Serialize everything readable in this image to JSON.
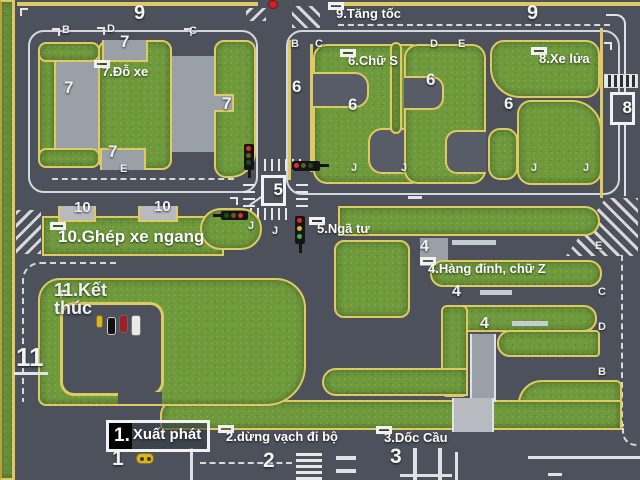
{
  "stations": {
    "start": {
      "num": "1.",
      "label": "Xuất phát"
    },
    "crosswalk": {
      "label": "2.dừng vạch đi bộ"
    },
    "bridge": {
      "label": "3.Dốc Cầu"
    },
    "zigzag": {
      "label": "4.Hàng đinh, chữ Z"
    },
    "intersection": {
      "label": "5.Ngã tư",
      "box": "5"
    },
    "s_curve": {
      "label": "6.Chữ S"
    },
    "parking": {
      "label": "7.Đỗ xe"
    },
    "railway": {
      "label": "8.Xe lửa",
      "box": "8"
    },
    "accelerate": {
      "label": "9.Tăng tốc"
    },
    "parallel": {
      "label": "10.Ghép xe ngang"
    },
    "finish": {
      "label": "11.Kết thúc",
      "big": "11"
    }
  },
  "markers": {
    "numbers": [
      {
        "text": "9",
        "x": 134,
        "y": 3,
        "size": 20
      },
      {
        "text": "9",
        "x": 527,
        "y": 3,
        "size": 20
      },
      {
        "text": "7",
        "x": 120,
        "y": 33,
        "size": 17
      },
      {
        "text": "7",
        "x": 64,
        "y": 79,
        "size": 17
      },
      {
        "text": "7",
        "x": 108,
        "y": 143,
        "size": 17
      },
      {
        "text": "7",
        "x": 222,
        "y": 95,
        "size": 17
      },
      {
        "text": "6",
        "x": 292,
        "y": 78,
        "size": 17
      },
      {
        "text": "6",
        "x": 348,
        "y": 96,
        "size": 17
      },
      {
        "text": "6",
        "x": 426,
        "y": 71,
        "size": 17
      },
      {
        "text": "6",
        "x": 504,
        "y": 95,
        "size": 17
      },
      {
        "text": "10",
        "x": 74,
        "y": 200,
        "size": 15
      },
      {
        "text": "10",
        "x": 154,
        "y": 199,
        "size": 15
      },
      {
        "text": "4",
        "x": 420,
        "y": 239,
        "size": 16
      },
      {
        "text": "4",
        "x": 452,
        "y": 284,
        "size": 16
      },
      {
        "text": "4",
        "x": 480,
        "y": 316,
        "size": 16
      },
      {
        "text": "1",
        "x": 112,
        "y": 448,
        "size": 21
      },
      {
        "text": "2",
        "x": 263,
        "y": 450,
        "size": 21
      },
      {
        "text": "3",
        "x": 390,
        "y": 446,
        "size": 21
      }
    ],
    "letters": [
      {
        "text": "B",
        "x": 62,
        "y": 25
      },
      {
        "text": "D",
        "x": 107,
        "y": 24
      },
      {
        "text": "C",
        "x": 189,
        "y": 26
      },
      {
        "text": "E",
        "x": 120,
        "y": 164
      },
      {
        "text": "B",
        "x": 291,
        "y": 39
      },
      {
        "text": "C",
        "x": 315,
        "y": 39
      },
      {
        "text": "D",
        "x": 430,
        "y": 39
      },
      {
        "text": "E",
        "x": 458,
        "y": 39
      },
      {
        "text": "J",
        "x": 351,
        "y": 163
      },
      {
        "text": "J",
        "x": 401,
        "y": 163
      },
      {
        "text": "J",
        "x": 531,
        "y": 163
      },
      {
        "text": "J",
        "x": 583,
        "y": 163
      },
      {
        "text": "J",
        "x": 248,
        "y": 221
      },
      {
        "text": "J",
        "x": 272,
        "y": 226
      },
      {
        "text": "E",
        "x": 595,
        "y": 241
      },
      {
        "text": "C",
        "x": 598,
        "y": 287
      },
      {
        "text": "D",
        "x": 598,
        "y": 322
      },
      {
        "text": "B",
        "x": 598,
        "y": 367
      }
    ]
  },
  "colors": {
    "road": "#4c515b",
    "grass": "#6f9a3c",
    "curb": "#dfc963",
    "pad": "#9aa0a8",
    "line_white": "#e8e8e8",
    "signal_red": "#d83030",
    "signal_yellow": "#d8b524",
    "signal_green": "#3fae4a"
  }
}
